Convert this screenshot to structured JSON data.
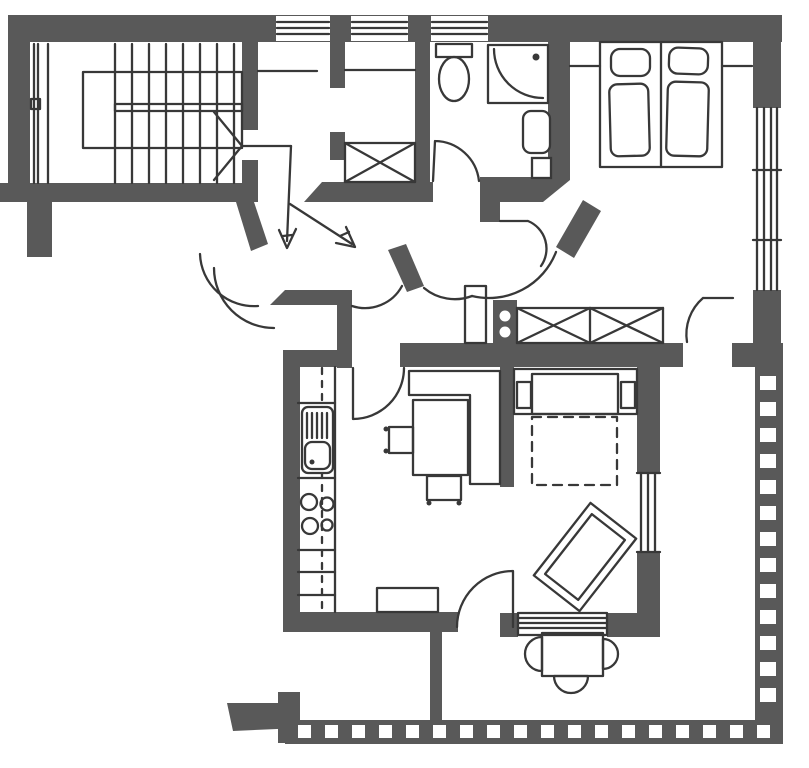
{
  "colors": {
    "background": "#ffffff",
    "wall": "#595959",
    "line": "#383838"
  },
  "symbols": {
    "staircase": "stair-flight-with-direction-line",
    "entrance": "two-entry-path-arrows",
    "doors": "quarter-circle-door-swings",
    "windows": "parallel-line-window-symbols",
    "closets": "crossed-box-wardrobe-symbols",
    "bathroom": [
      "toilet",
      "corner-shower",
      "washbasin"
    ],
    "bedroom": [
      "twin-beds",
      "pillows",
      "blankets"
    ],
    "kitchen": [
      "counter-run",
      "double-sink",
      "four-burner-stove",
      "base-cabinet",
      "dashed-upper-cabinet-line"
    ],
    "dining": [
      "corner-bench",
      "dining-table",
      "two-chairs"
    ],
    "living": [
      "sofa-bed",
      "dashed-fold-out-bed",
      "armchair"
    ],
    "balcony": [
      "checkered-railing",
      "round-table",
      "three-half-round-chairs",
      "balcony-divider"
    ]
  }
}
